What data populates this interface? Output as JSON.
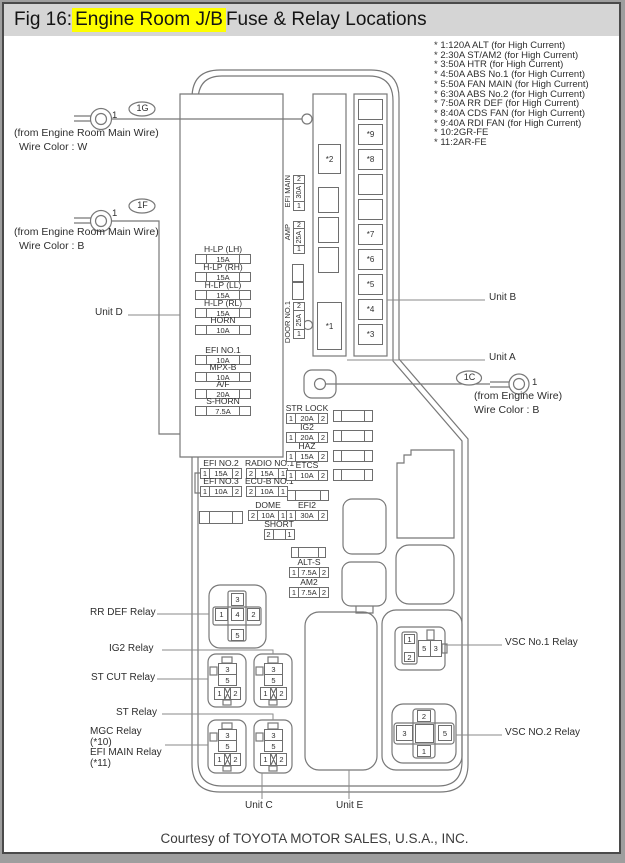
{
  "frame": {
    "title_prefix": "Fig 16: ",
    "title_highlight": "Engine Room J/B",
    "title_suffix": " Fuse & Relay Locations",
    "footer": "Courtesy of TOYOTA MOTOR SALES, U.S.A., INC."
  },
  "colors": {
    "highlight": "#ffff00",
    "titlebar_bg": "#d5d5d5",
    "line": "#787878"
  },
  "high_current_notes": [
    "* 1:120A ALT (for High Current)",
    "* 2:30A ST/AM2 (for High Current)",
    "* 3:50A HTR (for High Current)",
    "* 4:50A ABS No.1 (for High Current)",
    "* 5:50A FAN MAIN (for High Current)",
    "* 6:30A ABS No.2 (for High Current)",
    "* 7:50A RR DEF (for High Current)",
    "* 8:40A CDS FAN (for High Current)",
    "* 9:40A RDI FAN (for High Current)",
    "* 10:2GR-FE",
    "* 11:2AR-FE"
  ],
  "units": {
    "a": "Unit A",
    "b": "Unit B",
    "c": "Unit C",
    "d": "Unit D",
    "e": "Unit E"
  },
  "connector_1g": {
    "tag": "1G",
    "pin": "1",
    "line1": "(from Engine Room Main Wire)",
    "line2": "Wire Color : W"
  },
  "connector_1f": {
    "tag": "1F",
    "pin": "1",
    "line1": "(from Engine Room Main Wire)",
    "line2": "Wire Color : B"
  },
  "connector_1c": {
    "tag": "1C",
    "pin": "1",
    "line1": "(from Engine Wire)",
    "line2": "Wire Color : B"
  },
  "slots": {
    "s1": "*1",
    "s2": "*2",
    "s3": "*3",
    "s4": "*4",
    "s5": "*5",
    "s6": "*6",
    "s7": "*7",
    "s8": "*8",
    "s9": "*9"
  },
  "fuses": {
    "hlp_lh": {
      "label": "H-LP (LH)",
      "amp": "15A"
    },
    "hlp_rh": {
      "label": "H-LP (RH)",
      "amp": "15A"
    },
    "hlp_ll": {
      "label": "H-LP (LL)",
      "amp": "15A"
    },
    "hlp_rl": {
      "label": "H-LP (RL)",
      "amp": "15A"
    },
    "horn": {
      "label": "HORN",
      "amp": "10A"
    },
    "efi_no1": {
      "label": "EFI NO.1",
      "amp": "10A"
    },
    "mpx_b": {
      "label": "MPX-B",
      "amp": "10A"
    },
    "af": {
      "label": "A/F",
      "amp": "20A"
    },
    "s_horn": {
      "label": "S-HORN",
      "amp": "7.5A"
    },
    "efi_main": {
      "label": "EFI MAIN",
      "p1": "1",
      "amp": "30A",
      "p2": "2"
    },
    "amp_f": {
      "label": "AMP",
      "p1": "1",
      "amp": "25A",
      "p2": "2"
    },
    "door_no1": {
      "label": "DOOR NO.1",
      "p1": "1",
      "amp": "25A",
      "p2": "2"
    },
    "efi_no2": {
      "label": "EFI NO.2",
      "p1": "1",
      "amp": "15A",
      "p2": "2"
    },
    "radio_no1": {
      "label": "RADIO NO.1",
      "p1": "2",
      "amp": "15A",
      "p2": "1"
    },
    "efi_no3": {
      "label": "EFI NO.3",
      "p1": "1",
      "amp": "10A",
      "p2": "2"
    },
    "ecu_b_no1": {
      "label": "ECU-B NO.1",
      "p1": "2",
      "amp": "10A",
      "p2": "1"
    },
    "dome": {
      "label": "DOME",
      "p1": "2",
      "amp": "10A",
      "p2": "1"
    },
    "short": {
      "label": "SHORT",
      "p1": "2",
      "amp": "",
      "p2": "1"
    },
    "str_lock": {
      "label": "STR LOCK",
      "p1": "1",
      "amp": "20A",
      "p2": "2"
    },
    "ig2": {
      "label": "IG2",
      "p1": "1",
      "amp": "20A",
      "p2": "2"
    },
    "haz": {
      "label": "HAZ",
      "p1": "1",
      "amp": "15A",
      "p2": "2"
    },
    "etcs": {
      "label": "ETCS",
      "p1": "1",
      "amp": "10A",
      "p2": "2"
    },
    "efi2": {
      "label": "EFI2",
      "p1": "1",
      "amp": "30A",
      "p2": "2"
    },
    "alt_s": {
      "label": "ALT-S",
      "p1": "1",
      "amp": "7.5A",
      "p2": "2"
    },
    "am2": {
      "label": "AM2",
      "p1": "1",
      "amp": "7.5A",
      "p2": "2"
    }
  },
  "relays": {
    "rr_def": {
      "label": "RR DEF Relay",
      "pins": {
        "t": "3",
        "l": "1",
        "c": "4",
        "r": "2",
        "b": "5"
      }
    },
    "ig2": {
      "label": "IG2 Relay"
    },
    "st_cut": {
      "label": "ST CUT Relay"
    },
    "st": {
      "label": "ST Relay"
    },
    "mgc": {
      "label": "MGC Relay",
      "note": "(*10)"
    },
    "efi_main": {
      "label": "EFI MAIN Relay",
      "note": "(*11)"
    },
    "small_pins": {
      "t": "3",
      "m": "5",
      "l": "1",
      "r": "2"
    },
    "vsc1": {
      "label": "VSC No.1 Relay",
      "pins": {
        "a": "1",
        "b": "2",
        "c": "5",
        "d": "3"
      }
    },
    "vsc2": {
      "label": "VSC NO.2 Relay",
      "pins": {
        "t": "2",
        "l": "3",
        "r": "5",
        "b": "1"
      }
    }
  }
}
